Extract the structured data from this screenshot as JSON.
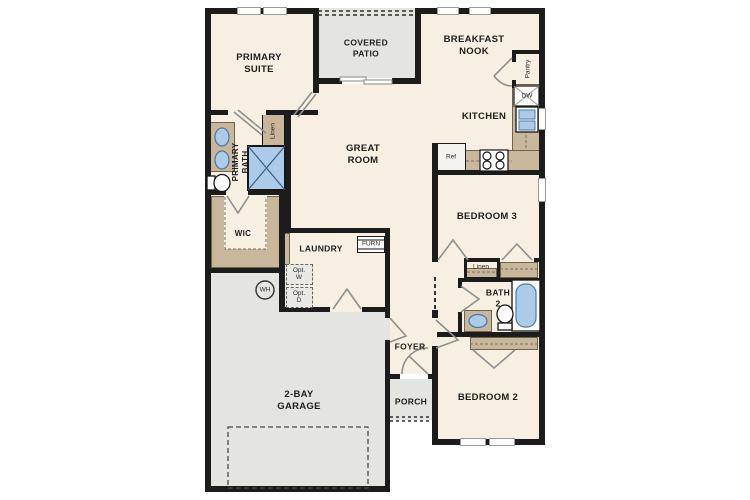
{
  "title": "Single-story house floor plan",
  "colors": {
    "wall": "#1c1c1c",
    "room": "#f7f0e2",
    "outdoor": "#e4e4e1",
    "counter": "#c9b79b",
    "counter_edge": "#6f6350",
    "fixture": "#abcbe8",
    "fixture_edge": "#4d7ba6",
    "door": "#8f8f8f",
    "text": "#1d1d1d"
  },
  "rooms": {
    "primary_suite": "PRIMARY\nSUITE",
    "covered_patio": "COVERED\nPATIO",
    "breakfast_nook": "BREAKFAST\nNOOK",
    "kitchen": "KITCHEN",
    "great_room": "GREAT\nROOM",
    "primary_bath": "PRIMARY\nBATH",
    "wic": "WIC",
    "laundry": "LAUNDRY",
    "bedroom3": "BEDROOM 3",
    "bath2": "BATH\n2",
    "bedroom2": "BEDROOM 2",
    "foyer": "FOYER",
    "porch": "PORCH",
    "garage": "2-BAY\nGARAGE"
  },
  "fixtures": {
    "linen_primary": "Linen",
    "linen_hall": "Linen",
    "pantry": "Pantry",
    "dishwasher": "DW",
    "refrigerator": "Ref",
    "furnace": "FURN",
    "opt_washer": "Opt.\nW",
    "opt_dryer": "Opt.\nD",
    "water_heater": "WH"
  }
}
